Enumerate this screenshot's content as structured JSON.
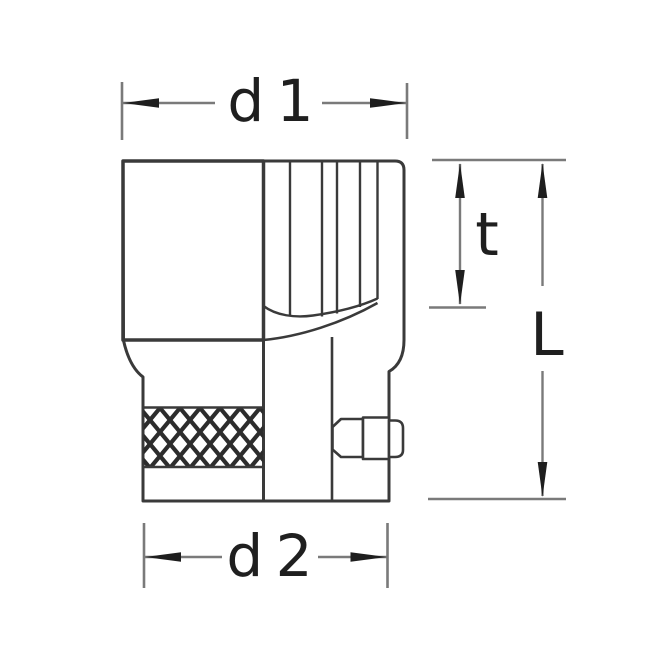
{
  "diagram": {
    "labels": {
      "d1": "d 1",
      "t": "t",
      "L": "L",
      "d2": "d 2"
    },
    "colors": {
      "background": "#ffffff",
      "outline": "#3a3a3a",
      "dimension_line": "#7a7a7a",
      "arrow": "#1e1e1e",
      "text": "#1f1f1f",
      "knurl": "#2c2c2c"
    }
  }
}
